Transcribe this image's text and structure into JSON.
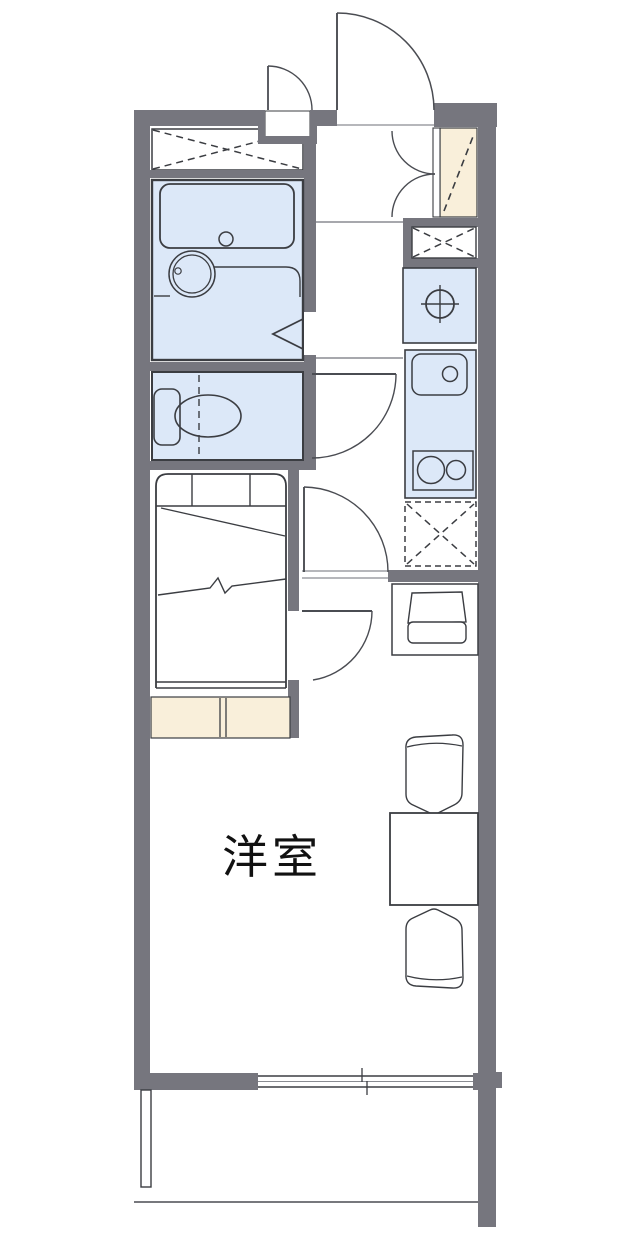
{
  "floorplan": {
    "room_label": "洋室",
    "elements": [
      "outer-walls",
      "entrance-door",
      "meter-box-door",
      "meter-box",
      "shoe-cabinet",
      "entry-closet-double-doors",
      "storage-closet-top",
      "unit-bath",
      "bathtub",
      "washbasin",
      "bath-folding-door",
      "toilet-room",
      "toilet",
      "toilet-door",
      "laundry-closet",
      "washing-machine-space",
      "kitchen-counter",
      "kitchen-sink",
      "gas-stove",
      "refrigerator-space",
      "hall-step-line",
      "main-room-door",
      "bed",
      "bed-room-door",
      "under-bed-storage",
      "desk",
      "desk-chair",
      "dining-table",
      "dining-chair-top",
      "dining-chair-bottom",
      "sliding-window",
      "balcony"
    ]
  },
  "colors": {
    "bg": "#ffffff",
    "wall": "#76767e",
    "water": "#dce8f8",
    "wood": "#f9efda",
    "line": "#3b3d42",
    "door": "#4a4c52",
    "label": "#111111"
  }
}
